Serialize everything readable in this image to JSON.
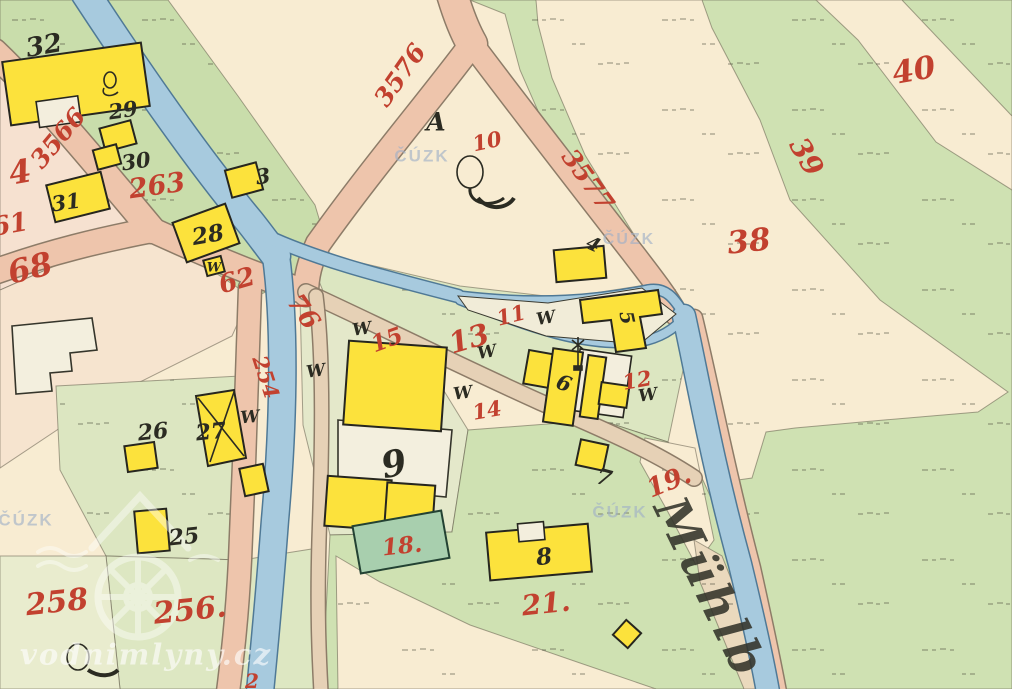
{
  "map": {
    "type": "historical cadastral map",
    "watermark_agency": "ČÚZK",
    "watermark_site": "vodnimlyny.cz",
    "w_letter": "W",
    "colors": {
      "paper": "#f7e9cf",
      "meadow": "#cfe0ae",
      "road": "#eec5ac",
      "water": "#a7cade",
      "building": "#fce23c",
      "red": "#c2412f",
      "black": "#2b2b22"
    },
    "river_label": {
      "t": "Mühlb",
      "x": 710,
      "y": 588,
      "r": 64,
      "s": 48
    },
    "red_labels": [
      {
        "t": "3566",
        "x": 58,
        "y": 138,
        "r": -50,
        "s": 25
      },
      {
        "t": "4",
        "x": 20,
        "y": 172,
        "r": -10,
        "s": 32
      },
      {
        "t": "61",
        "x": 10,
        "y": 225,
        "r": -10,
        "s": 26
      },
      {
        "t": "68",
        "x": 30,
        "y": 268,
        "r": -14,
        "s": 32
      },
      {
        "t": "263",
        "x": 157,
        "y": 186,
        "r": -8,
        "s": 27
      },
      {
        "t": "3576",
        "x": 400,
        "y": 75,
        "r": -55,
        "s": 25
      },
      {
        "t": "10",
        "x": 487,
        "y": 141,
        "r": -12,
        "s": 21
      },
      {
        "t": "3577",
        "x": 588,
        "y": 180,
        "r": 54,
        "s": 25
      },
      {
        "t": "40",
        "x": 914,
        "y": 71,
        "r": -10,
        "s": 31
      },
      {
        "t": "39",
        "x": 806,
        "y": 157,
        "r": 60,
        "s": 28
      },
      {
        "t": "38",
        "x": 749,
        "y": 242,
        "r": -6,
        "s": 31
      },
      {
        "t": "62",
        "x": 237,
        "y": 281,
        "r": -16,
        "s": 26
      },
      {
        "t": "76",
        "x": 303,
        "y": 312,
        "r": 55,
        "s": 26
      },
      {
        "t": "254",
        "x": 266,
        "y": 377,
        "r": 72,
        "s": 21
      },
      {
        "t": "15",
        "x": 387,
        "y": 340,
        "r": -20,
        "s": 23
      },
      {
        "t": "13",
        "x": 469,
        "y": 339,
        "r": -16,
        "s": 29
      },
      {
        "t": "11",
        "x": 511,
        "y": 315,
        "r": -14,
        "s": 21
      },
      {
        "t": "14",
        "x": 487,
        "y": 410,
        "r": -10,
        "s": 21
      },
      {
        "t": "12",
        "x": 637,
        "y": 380,
        "r": -10,
        "s": 21
      },
      {
        "t": "19.",
        "x": 669,
        "y": 482,
        "r": -22,
        "s": 26
      },
      {
        "t": "21.",
        "x": 546,
        "y": 604,
        "r": -6,
        "s": 28
      },
      {
        "t": "18.",
        "x": 402,
        "y": 546,
        "r": -6,
        "s": 23
      },
      {
        "t": "258",
        "x": 57,
        "y": 603,
        "r": -6,
        "s": 30
      },
      {
        "t": "256.",
        "x": 190,
        "y": 611,
        "r": -6,
        "s": 30
      },
      {
        "t": "2",
        "x": 252,
        "y": 681,
        "r": 0,
        "s": 20
      }
    ],
    "black_labels": [
      {
        "t": "32",
        "x": 44,
        "y": 46,
        "r": -10,
        "s": 26
      },
      {
        "t": "29",
        "x": 123,
        "y": 110,
        "r": -8,
        "s": 21
      },
      {
        "t": "30",
        "x": 136,
        "y": 161,
        "r": -8,
        "s": 21
      },
      {
        "t": "31",
        "x": 66,
        "y": 202,
        "r": -8,
        "s": 21
      },
      {
        "t": "3",
        "x": 263,
        "y": 176,
        "r": -8,
        "s": 21
      },
      {
        "t": "28",
        "x": 208,
        "y": 235,
        "r": -10,
        "s": 23
      },
      {
        "t": "A",
        "x": 436,
        "y": 122,
        "r": 0,
        "s": 25
      },
      {
        "t": "4",
        "x": 593,
        "y": 245,
        "r": 25,
        "s": 19
      },
      {
        "t": "5",
        "x": 626,
        "y": 318,
        "r": 78,
        "s": 19
      },
      {
        "t": "6",
        "x": 564,
        "y": 383,
        "r": 20,
        "s": 21
      },
      {
        "t": "9",
        "x": 394,
        "y": 464,
        "r": -12,
        "s": 36
      },
      {
        "t": "7",
        "x": 604,
        "y": 478,
        "r": 15,
        "s": 22
      },
      {
        "t": "8",
        "x": 544,
        "y": 557,
        "r": -6,
        "s": 23
      },
      {
        "t": "26",
        "x": 153,
        "y": 432,
        "r": -6,
        "s": 22
      },
      {
        "t": "27",
        "x": 211,
        "y": 432,
        "r": -6,
        "s": 22
      },
      {
        "t": "25",
        "x": 184,
        "y": 537,
        "r": -6,
        "s": 22
      }
    ],
    "w_marks": [
      {
        "x": 362,
        "y": 330,
        "r": -8,
        "s": 17
      },
      {
        "x": 316,
        "y": 372,
        "r": -8,
        "s": 17
      },
      {
        "x": 250,
        "y": 418,
        "r": -5,
        "s": 17
      },
      {
        "x": 487,
        "y": 353,
        "r": -10,
        "s": 17
      },
      {
        "x": 463,
        "y": 394,
        "r": -8,
        "s": 17
      },
      {
        "x": 546,
        "y": 319,
        "r": -10,
        "s": 17
      },
      {
        "x": 648,
        "y": 396,
        "r": -8,
        "s": 17
      },
      {
        "x": 214,
        "y": 268,
        "r": 0,
        "s": 13
      }
    ],
    "cuzk_marks": [
      {
        "x": 422,
        "y": 156,
        "s": 17
      },
      {
        "x": 629,
        "y": 240,
        "s": 16
      },
      {
        "x": 620,
        "y": 512,
        "s": 17
      },
      {
        "x": 26,
        "y": 520,
        "s": 17
      }
    ],
    "site_mark": {
      "x": 146,
      "y": 655,
      "r": 0,
      "s": 29
    }
  }
}
